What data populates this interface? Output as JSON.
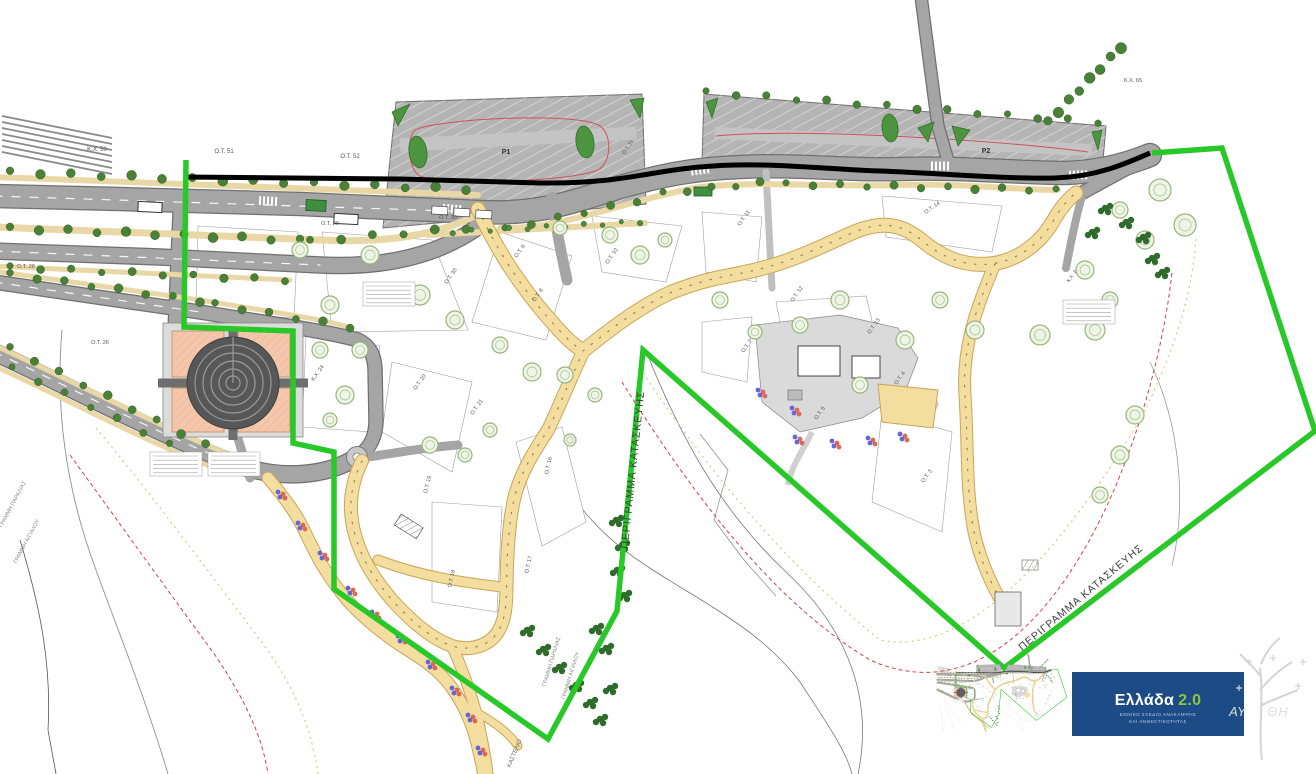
{
  "map": {
    "labels": [
      {
        "t": "Κ.Χ. 50",
        "x": 97,
        "y": 151,
        "s": 6
      },
      {
        "t": "Ο.Τ. 51",
        "x": 224,
        "y": 153,
        "s": 6
      },
      {
        "t": "Ο.Τ. 52",
        "x": 350,
        "y": 158,
        "s": 6
      },
      {
        "t": "Ο.Τ. 29",
        "x": 330,
        "y": 225
      },
      {
        "t": "Ο.Τ. 30",
        "x": 448,
        "y": 219
      },
      {
        "t": "Ο.Τ. 30",
        "x": 452,
        "y": 277,
        "r": -55
      },
      {
        "t": "Ο.Τ. 6",
        "x": 521,
        "y": 252,
        "r": -55
      },
      {
        "t": "Ο.Τ. 8",
        "x": 539,
        "y": 296,
        "r": -55
      },
      {
        "t": "Ο.Τ. 10",
        "x": 613,
        "y": 257,
        "r": -55
      },
      {
        "t": "Ο.Τ. 31",
        "x": 629,
        "y": 148,
        "r": -55,
        "s": 5
      },
      {
        "t": "Ο.Τ. 28",
        "x": 26,
        "y": 268
      },
      {
        "t": "Ο.Τ. 26",
        "x": 100,
        "y": 344
      },
      {
        "t": "Κ.Χ. 24",
        "x": 319,
        "y": 374,
        "r": -55
      },
      {
        "t": "Ο.Τ. 20",
        "x": 421,
        "y": 383,
        "r": -55
      },
      {
        "t": "Ο.Τ. 21",
        "x": 478,
        "y": 408,
        "r": -55
      },
      {
        "t": "Ο.Τ. 19",
        "x": 429,
        "y": 485,
        "r": -75
      },
      {
        "t": "Ο.Τ. 18",
        "x": 453,
        "y": 579,
        "r": -78
      },
      {
        "t": "Ο.Τ. 17",
        "x": 530,
        "y": 565,
        "r": -78
      },
      {
        "t": "Ο.Τ. 16",
        "x": 550,
        "y": 466,
        "r": -78
      },
      {
        "t": "Ο.Τ. 11",
        "x": 745,
        "y": 219,
        "r": -55
      },
      {
        "t": "Ο.Τ. 14",
        "x": 933,
        "y": 209,
        "r": -35
      },
      {
        "t": "Ο.Τ. 12",
        "x": 798,
        "y": 295,
        "r": -55
      },
      {
        "t": "Ο.Τ. 13",
        "x": 875,
        "y": 327,
        "r": -55
      },
      {
        "t": "Κ.Χ. 2",
        "x": 1073,
        "y": 277,
        "r": -55,
        "s": 5
      },
      {
        "t": "Ο.Τ. 7",
        "x": 748,
        "y": 347,
        "r": -55
      },
      {
        "t": "Ο.Τ. 5",
        "x": 821,
        "y": 414,
        "r": -55
      },
      {
        "t": "Ο.Τ. 4",
        "x": 901,
        "y": 379,
        "r": -55
      },
      {
        "t": "Ο.Τ. 3",
        "x": 928,
        "y": 477,
        "r": -55
      },
      {
        "t": "Κ.Χ. 65",
        "x": 1133,
        "y": 82,
        "s": 5.5
      },
      {
        "t": "P1",
        "x": 506,
        "y": 154,
        "s": 7,
        "b": 1,
        "c": "#333333",
        "k": "parking-label"
      },
      {
        "t": "P2",
        "x": 986,
        "y": 153,
        "s": 7,
        "b": 1,
        "c": "#333333",
        "k": "parking-label"
      },
      {
        "t": "ΠΕΡΙΓΡΑΜΜΑ ΚΑΤΑΣΚΕΥΗΣ",
        "x": 636,
        "y": 470,
        "r": -84,
        "s": 10.5,
        "c": "#3c3c3c",
        "ls": 1,
        "k": "construction-outline-label"
      },
      {
        "t": "ΠΕΡΙΓΡΑΜΜΑ ΚΑΤΑΣΚΕΥΗΣ",
        "x": 1083,
        "y": 600,
        "r": -40,
        "s": 10.5,
        "c": "#3c3c3c",
        "ls": 1,
        "k": "construction-outline-label"
      },
      {
        "t": "ΓΡΑΜΜΗ ΠΑΡΑΛΙΑΣ",
        "x": 14,
        "y": 505,
        "r": -62,
        "s": 5.5,
        "c": "#8a8a8a",
        "k": "shoreline-label"
      },
      {
        "t": "ΓΡΑΜΜΗ ΑΙΓΙΑΛΟΥ",
        "x": 28,
        "y": 542,
        "r": -62,
        "s": 5.5,
        "c": "#8a8a8a",
        "k": "shoreline-label"
      },
      {
        "t": "ΓΡΑΜΜΗ ΠΑΡΑΛΙΑΣ",
        "x": 553,
        "y": 662,
        "r": -73,
        "s": 5.5,
        "c": "#8a8a8a",
        "k": "shoreline-label"
      },
      {
        "t": "ΓΡΑΜΜΗ ΑΙΓΙΑΛΟΥ",
        "x": 572,
        "y": 676,
        "r": -73,
        "s": 5.5,
        "c": "#8a8a8a",
        "k": "shoreline-label"
      },
      {
        "t": "ΚΑΣΤΕΛΙΟ",
        "x": 516,
        "y": 754,
        "r": -68,
        "s": 6,
        "c": "#6a6a6a",
        "k": "place-label"
      }
    ]
  },
  "logo": {
    "brand": "Ελλάδα",
    "version": "2.0",
    "subtitle1": "ΕΘΝΙΚΟ ΣΧΕΔΙΟ ΑΝΑΚΑΜΨΗΣ",
    "subtitle2": "ΚΑΙ ΑΝΘΕΚΤΙΚΟΤΗΤΑΣ",
    "bg": "#1d4b85",
    "accent": "#8dc63f"
  },
  "watermark": {
    "left": "ΑΥ",
    "right": "ΘΗ"
  },
  "colors": {
    "construction_outline": "#28c828",
    "road_axis": "#000000",
    "road": "#a5a5a5",
    "pedestrian_path": "#f3dd9f",
    "planter_strip": "#ead7a6",
    "plaza_circle": "#575757",
    "planted_square": "#f4c6ab",
    "tree": "#4a8038",
    "flower_blue": "#6366d8",
    "flower_red": "#dd6a4e",
    "shoreline_red": "#cc4444",
    "shoreline_tan": "#d9c87c"
  }
}
